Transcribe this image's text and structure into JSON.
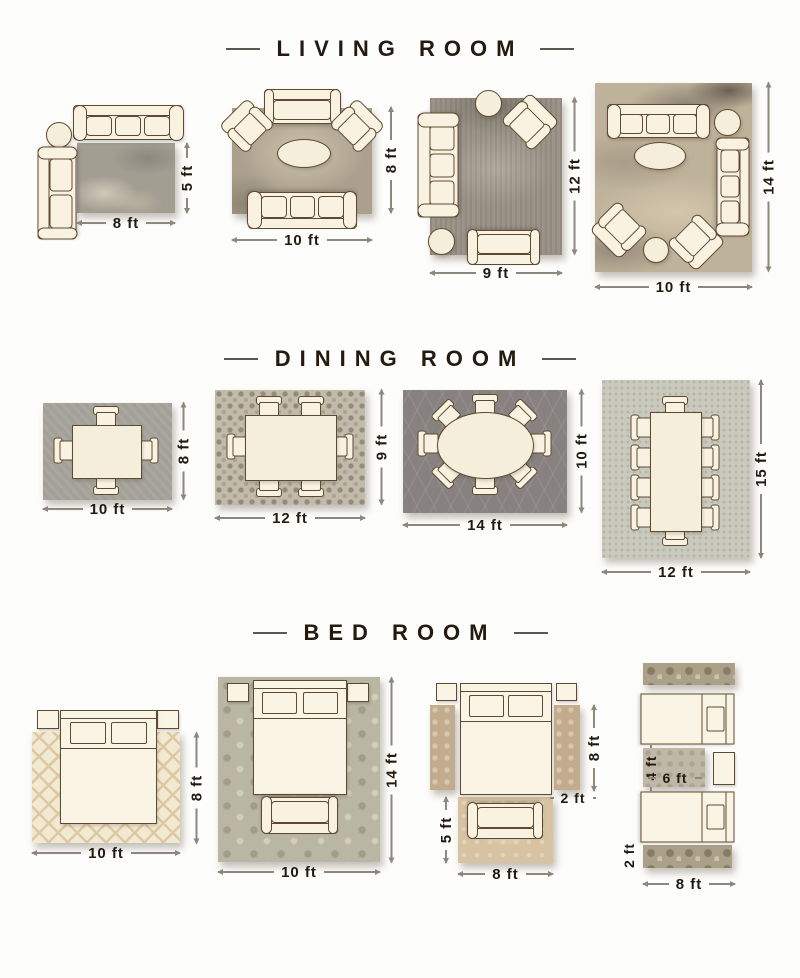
{
  "page": {
    "background": "#fdfdfb"
  },
  "palette": {
    "furniture_fill": "#f9f2e0",
    "furniture_outline": "#5e4a33",
    "dimension_text": "#221910",
    "dimension_line": "#8d887e",
    "header_text": "#241a10"
  },
  "sections": {
    "living": {
      "title": "LIVING ROOM",
      "layouts": [
        {
          "w": "8 ft",
          "h": "5 ft"
        },
        {
          "w": "10 ft",
          "h": "8 ft"
        },
        {
          "w": "9 ft",
          "h": "12 ft"
        },
        {
          "w": "10 ft",
          "h": "14 ft"
        }
      ]
    },
    "dining": {
      "title": "DINING ROOM",
      "layouts": [
        {
          "w": "10 ft",
          "h": "8 ft"
        },
        {
          "w": "12 ft",
          "h": "9 ft"
        },
        {
          "w": "14 ft",
          "h": "10 ft"
        },
        {
          "w": "12 ft",
          "h": "15 ft"
        }
      ]
    },
    "bedroom": {
      "title": "BED ROOM",
      "layouts": [
        {
          "w": "10 ft",
          "h": "8 ft"
        },
        {
          "w": "10 ft",
          "h": "14 ft"
        },
        {
          "runner_h": "8 ft",
          "runner_w": "2 ft",
          "accent_h": "5 ft",
          "accent_w": "8 ft"
        },
        {
          "small_h": "4 ft",
          "small_w": "6 ft",
          "runner_w": "2 ft",
          "runner_len": "8 ft"
        }
      ]
    }
  }
}
